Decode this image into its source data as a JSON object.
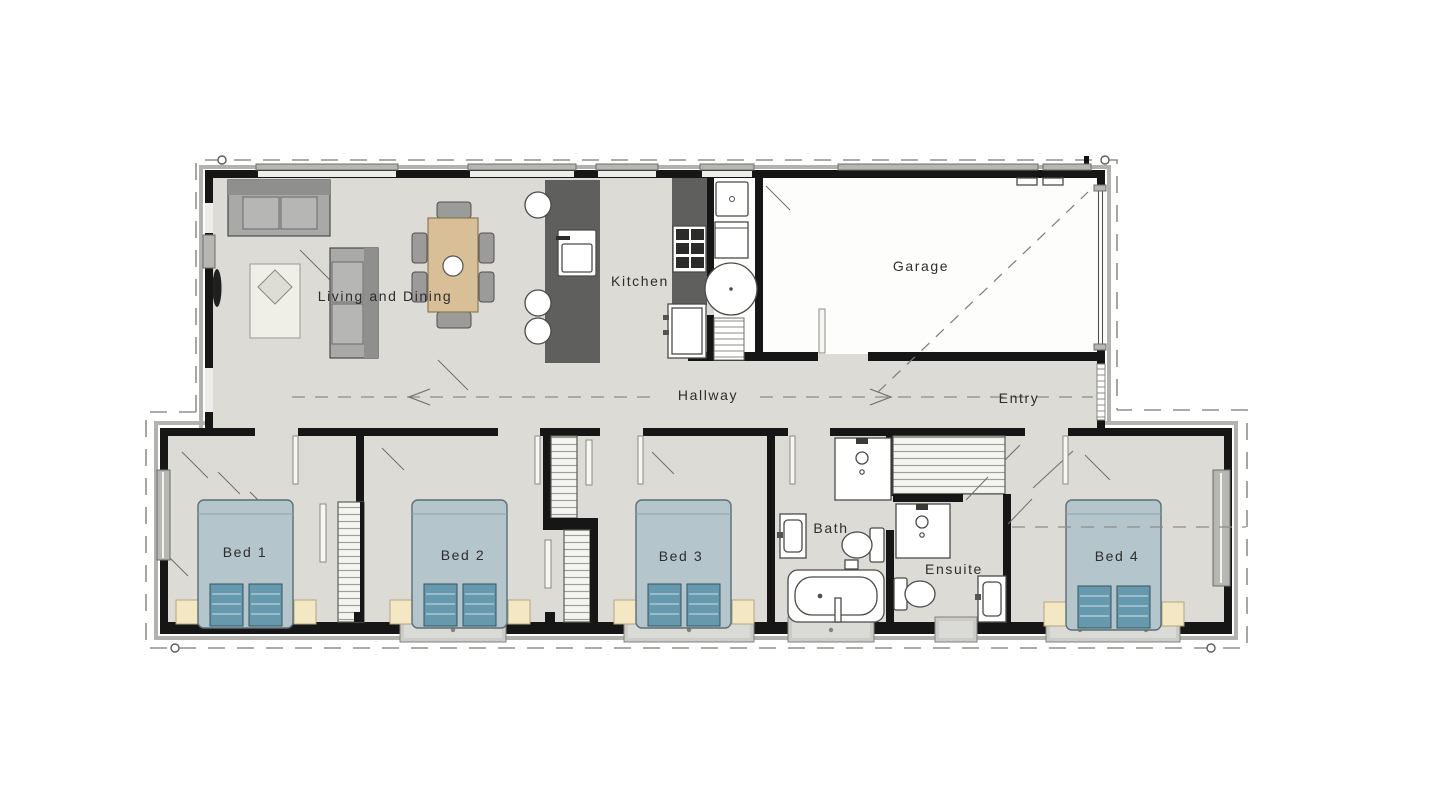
{
  "rooms": {
    "living": {
      "label": "Living and Dining"
    },
    "kitchen": {
      "label": "Kitchen"
    },
    "garage": {
      "label": "Garage"
    },
    "hallway": {
      "label": "Hallway"
    },
    "entry": {
      "label": "Entry"
    },
    "bed1": {
      "label": "Bed 1"
    },
    "bed2": {
      "label": "Bed 2"
    },
    "bed3": {
      "label": "Bed 3"
    },
    "bath": {
      "label": "Bath"
    },
    "ensuite": {
      "label": "Ensuite"
    },
    "bed4": {
      "label": "Bed 4"
    }
  },
  "colors": {
    "wall": "#161616",
    "floor": "#dcdbd5",
    "garage_floor": "#fdfdfc",
    "counter": "#5f5f5d",
    "table": "#d8bf98",
    "bed": "#b5c5cc",
    "pillow": "#6699ad",
    "nightstand": "#f3e7c4",
    "cladding": "#b2b2ae",
    "roofline": "#8f8f8b",
    "label": "#2d2d2d"
  }
}
